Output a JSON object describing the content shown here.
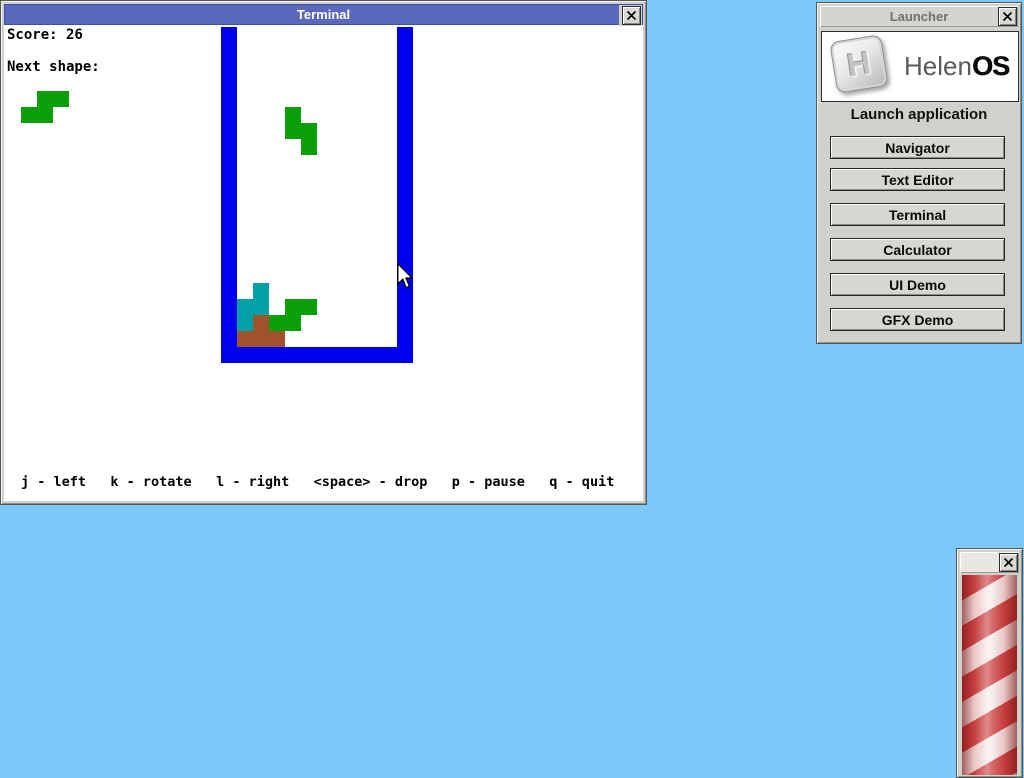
{
  "desktop": {
    "bg_color": "#7cc8f8"
  },
  "terminal_window": {
    "title": "Terminal",
    "score_text": "Score: 26",
    "next_shape_label": "Next shape:",
    "help_text": "j - left   k - rotate   l - right   <space> - drop   p - pause   q - quit",
    "title_bar_color": "#5a69be",
    "game": {
      "colors": {
        "wall": "#0000f0",
        "green": "#0a9f0a",
        "teal": "#00a0a4",
        "brown": "#a0522d"
      },
      "blocks": [
        {
          "name": "left-wall",
          "x": 220,
          "y": 26,
          "w": 16,
          "h": 336,
          "color": "wall"
        },
        {
          "name": "right-wall",
          "x": 396,
          "y": 26,
          "w": 16,
          "h": 336,
          "color": "wall"
        },
        {
          "name": "floor-wall",
          "x": 220,
          "y": 346,
          "w": 192,
          "h": 16,
          "color": "wall"
        },
        {
          "name": "next-shape-cell",
          "x": 36,
          "y": 90,
          "w": 16,
          "h": 16,
          "color": "green"
        },
        {
          "name": "next-shape-cell",
          "x": 52,
          "y": 90,
          "w": 16,
          "h": 16,
          "color": "green"
        },
        {
          "name": "next-shape-cell",
          "x": 20,
          "y": 106,
          "w": 16,
          "h": 16,
          "color": "green"
        },
        {
          "name": "next-shape-cell",
          "x": 36,
          "y": 106,
          "w": 16,
          "h": 16,
          "color": "green"
        },
        {
          "name": "falling-piece-cell",
          "x": 284,
          "y": 106,
          "w": 16,
          "h": 16,
          "color": "green"
        },
        {
          "name": "falling-piece-cell",
          "x": 284,
          "y": 122,
          "w": 16,
          "h": 16,
          "color": "green"
        },
        {
          "name": "falling-piece-cell",
          "x": 300,
          "y": 122,
          "w": 16,
          "h": 16,
          "color": "green"
        },
        {
          "name": "falling-piece-cell",
          "x": 300,
          "y": 138,
          "w": 16,
          "h": 16,
          "color": "green"
        },
        {
          "name": "stack-cell",
          "x": 252,
          "y": 282,
          "w": 16,
          "h": 16,
          "color": "teal"
        },
        {
          "name": "stack-cell",
          "x": 252,
          "y": 298,
          "w": 16,
          "h": 16,
          "color": "teal"
        },
        {
          "name": "stack-cell",
          "x": 236,
          "y": 298,
          "w": 16,
          "h": 16,
          "color": "teal"
        },
        {
          "name": "stack-cell",
          "x": 236,
          "y": 314,
          "w": 16,
          "h": 16,
          "color": "teal"
        },
        {
          "name": "stack-cell",
          "x": 284,
          "y": 298,
          "w": 16,
          "h": 16,
          "color": "green"
        },
        {
          "name": "stack-cell",
          "x": 300,
          "y": 298,
          "w": 16,
          "h": 16,
          "color": "green"
        },
        {
          "name": "stack-cell",
          "x": 268,
          "y": 314,
          "w": 16,
          "h": 16,
          "color": "green"
        },
        {
          "name": "stack-cell",
          "x": 284,
          "y": 314,
          "w": 16,
          "h": 16,
          "color": "green"
        },
        {
          "name": "stack-cell",
          "x": 252,
          "y": 314,
          "w": 16,
          "h": 16,
          "color": "brown"
        },
        {
          "name": "stack-cell",
          "x": 236,
          "y": 330,
          "w": 16,
          "h": 16,
          "color": "brown"
        },
        {
          "name": "stack-cell",
          "x": 252,
          "y": 330,
          "w": 16,
          "h": 16,
          "color": "brown"
        },
        {
          "name": "stack-cell",
          "x": 268,
          "y": 330,
          "w": 16,
          "h": 16,
          "color": "brown"
        }
      ]
    }
  },
  "launcher_window": {
    "title": "Launcher",
    "logo_badge_letter": "H",
    "logo_text_light": "Helen",
    "logo_text_bold": "OS",
    "subtitle": "Launch application",
    "buttons": [
      "Navigator",
      "Text Editor",
      "Terminal",
      "Calculator",
      "UI Demo",
      "GFX Demo"
    ],
    "button_tops": [
      133,
      165,
      200,
      235,
      270,
      305
    ]
  },
  "demo_window": {
    "title": "",
    "colors": {
      "stripe_red": "#cc4343",
      "stripe_white": "#f6e9e8",
      "edge_shade": "#6e0a0a"
    }
  }
}
